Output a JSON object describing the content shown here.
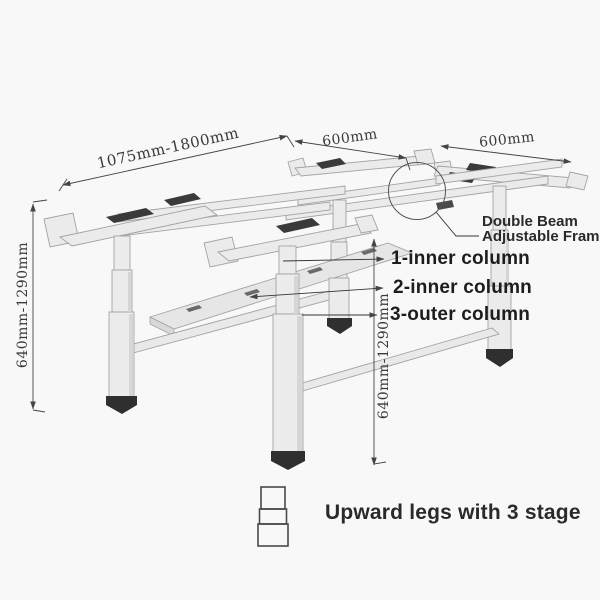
{
  "dims": {
    "width": "1075mm-1800mm",
    "depth_left": "600mm",
    "depth_right": "600mm",
    "height_left": "640mm-1290mm",
    "height_center": "640mm-1290mm"
  },
  "callout": {
    "line1": "Double Beam",
    "line2": "Adjustable Frame length"
  },
  "columns": [
    {
      "text": "1-inner column"
    },
    {
      "text": "2-inner column"
    },
    {
      "text": "3-outer column"
    }
  ],
  "footer": {
    "text": "Upward legs with 3 stage"
  },
  "icons": [
    {
      "name": "three-stage-leg-icon"
    }
  ],
  "colors": {
    "background": "#f8f8f8",
    "frame_fill": "#ebebeb",
    "frame_edge": "#a3a3a3",
    "accent_dark": "#3a3a3a",
    "dimension_line": "#444444",
    "text": "#222222"
  }
}
